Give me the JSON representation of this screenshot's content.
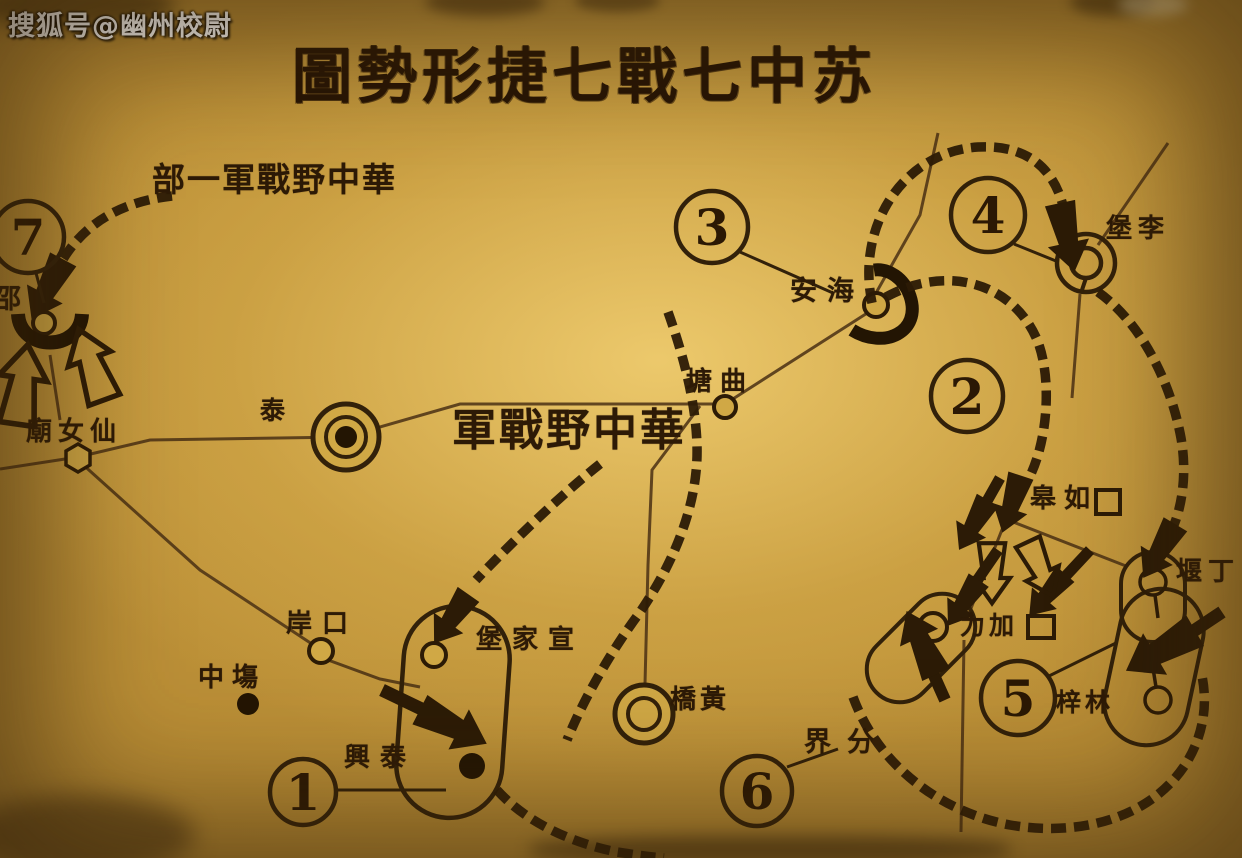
{
  "watermark": "搜狐号@幽州校尉",
  "title": {
    "display": "圖勢形捷七戰七中苏",
    "reading_right_to_left": "苏中七戰七捷形勢圖"
  },
  "army_labels": [
    {
      "display": "部一軍戰野中華",
      "reading_right_to_left": "華中野戰軍一部"
    },
    {
      "display": "軍戰野中華",
      "reading_right_to_left": "華中野戰軍"
    }
  ],
  "battle_markers": [
    {
      "number": "1"
    },
    {
      "number": "2"
    },
    {
      "number": "3"
    },
    {
      "number": "4"
    },
    {
      "number": "5"
    },
    {
      "number": "6"
    },
    {
      "number": "7"
    }
  ],
  "places": [
    {
      "display": "邵",
      "reading": "邵",
      "symbol": "small-circle-with-horseshoe"
    },
    {
      "display": "廟女仙",
      "reading": "仙女廟",
      "symbol": "hexagon"
    },
    {
      "display": "泰",
      "reading": "泰",
      "symbol": "bullseye-city"
    },
    {
      "display": "塘曲",
      "reading": "曲塘",
      "symbol": "small-circle"
    },
    {
      "display": "安海",
      "reading": "海安",
      "symbol": "small-circle-with-arc"
    },
    {
      "display": "堡李",
      "reading": "李堡",
      "symbol": "double-circle"
    },
    {
      "display": "皋如",
      "reading": "如皋",
      "symbol": "square"
    },
    {
      "display": "堰丁",
      "reading": "丁堰",
      "symbol": "oval-with-circle"
    },
    {
      "display": "力加",
      "reading": "加力",
      "symbol": "square-and-oval"
    },
    {
      "display": "梓林",
      "reading": "林梓",
      "symbol": "oval-with-circle"
    },
    {
      "display": "界分",
      "reading": "分界",
      "symbol": "none"
    },
    {
      "display": "堡家宣",
      "reading": "宣家堡",
      "symbol": "small-circle-in-loop"
    },
    {
      "display": "興泰",
      "reading": "泰興",
      "symbol": "filled-dot-in-loop"
    },
    {
      "display": "岸口",
      "reading": "口岸",
      "symbol": "small-circle"
    },
    {
      "display": "中塲",
      "reading": "中塲",
      "symbol": "filled-dot"
    },
    {
      "display": "橋黃",
      "reading": "黃橋",
      "symbol": "double-circle"
    }
  ],
  "colors": {
    "paper": "#c89d40",
    "ink": "#2c1b06",
    "road": "#4a3014",
    "title_ink": "#261404",
    "watermark_text": "#ffffff"
  }
}
